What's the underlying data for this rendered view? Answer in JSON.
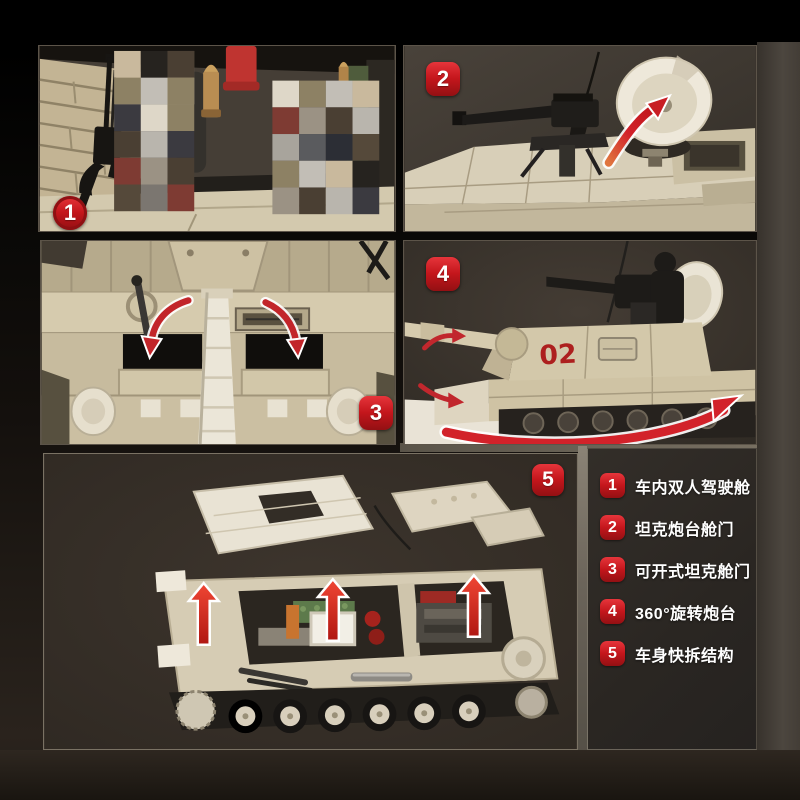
{
  "colors": {
    "accent_red": "#c1272d",
    "badge_red": "#c4161c",
    "tank_beige": "#d6cbae",
    "panel_background": "#3b342d",
    "legend_background": "#2d2925",
    "page_background": "#000000",
    "legend_text": "#ffffff"
  },
  "panels": [
    {
      "badge": "1",
      "name": "interior-two-seat-cockpit"
    },
    {
      "badge": "2",
      "name": "turret-machine-gun-hatch"
    },
    {
      "badge": "3",
      "name": "openable-tank-hatches"
    },
    {
      "badge": "4",
      "name": "rotating-turret",
      "turret_marking": "02"
    },
    {
      "badge": "5",
      "name": "quick-release-body"
    }
  ],
  "legend": {
    "items": [
      {
        "num": "1",
        "label": "车内双人驾驶舱"
      },
      {
        "num": "2",
        "label": "坦克炮台舱门"
      },
      {
        "num": "3",
        "label": "可开式坦克舱门"
      },
      {
        "num": "4",
        "label": "360°旋转炮台"
      },
      {
        "num": "5",
        "label": "车身快拆结构"
      }
    ]
  },
  "panel1_mosaic": {
    "palette": [
      "#a8a49c",
      "#c9b99d",
      "#ded7c8",
      "#4a3f33",
      "#7b7670",
      "#5a5b5e",
      "#26231f",
      "#8d8164",
      "#b9b5ad",
      "#7e3b33",
      "#2c2e35",
      "#6e6457",
      "#c2beb6",
      "#3b3a40",
      "#9b9284",
      "#55493a"
    ]
  }
}
